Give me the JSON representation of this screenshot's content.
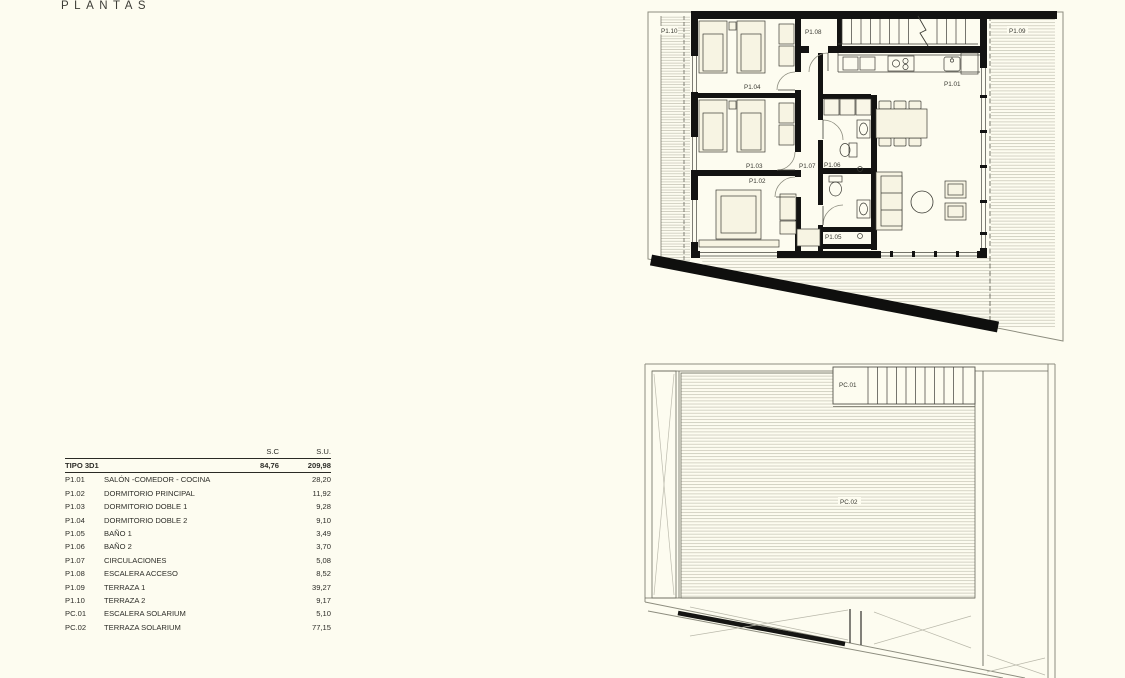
{
  "page": {
    "title": "PLANTAS",
    "background": "#fdfcf0"
  },
  "colors": {
    "background": "#fdfcf0",
    "wall": "#131312",
    "thin_line": "#54544a",
    "hatch": "#c6c5b6",
    "text": "#2e2e29"
  },
  "area_table": {
    "col_sc": "S.C",
    "col_su": "S.U.",
    "tipo": {
      "label": "TIPO 3D1",
      "sc": "84,76",
      "su": "209,98"
    },
    "rows": [
      {
        "code": "P1.01",
        "name": "SALÓN -COMEDOR - COCINA",
        "su": "28,20"
      },
      {
        "code": "P1.02",
        "name": "DORMITORIO PRINCIPAL",
        "su": "11,92"
      },
      {
        "code": "P1.03",
        "name": "DORMITORIO DOBLE 1",
        "su": "9,28"
      },
      {
        "code": "P1.04",
        "name": "DORMITORIO DOBLE 2",
        "su": "9,10"
      },
      {
        "code": "P1.05",
        "name": "BAÑO 1",
        "su": "3,49"
      },
      {
        "code": "P1.06",
        "name": "BAÑO 2",
        "su": "3,70"
      },
      {
        "code": "P1.07",
        "name": "CIRCULACIONES",
        "su": "5,08"
      },
      {
        "code": "P1.08",
        "name": "ESCALERA ACCESO",
        "su": "8,52"
      },
      {
        "code": "P1.09",
        "name": "TERRAZA 1",
        "su": "39,27"
      },
      {
        "code": "P1.10",
        "name": "TERRAZA 2",
        "su": "9,17"
      },
      {
        "code": "PC.01",
        "name": "ESCALERA SOLARIUM",
        "su": "5,10"
      },
      {
        "code": "PC.02",
        "name": "TERRAZA SOLARIUM",
        "su": "77,15"
      }
    ]
  },
  "plan1": {
    "labels": {
      "p101": "P1.01",
      "p102": "P1.02",
      "p103": "P1.03",
      "p104": "P1.04",
      "p105": "P1.05",
      "p106": "P1.06",
      "p107": "P1.07",
      "p108": "P1.08",
      "p109": "P1.09",
      "p110": "P1.10"
    }
  },
  "plan2": {
    "labels": {
      "pc01": "PC.01",
      "pc02": "PC.02"
    }
  }
}
